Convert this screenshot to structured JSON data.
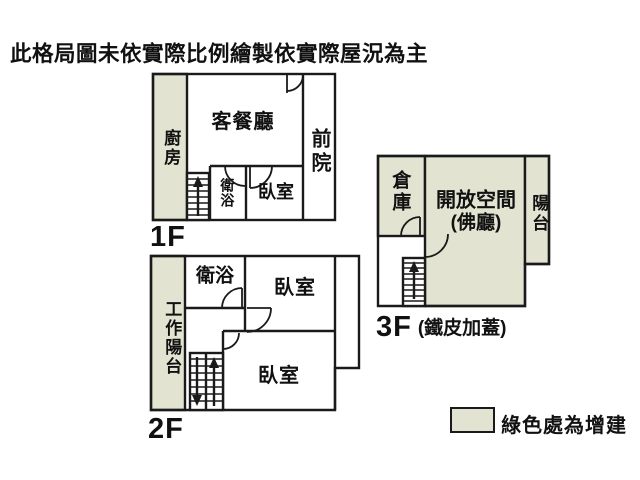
{
  "title": "此格局圖未依實際比例繪製依實際屋況為主",
  "colors": {
    "addition_green": "#e2e4d1",
    "wall": "#1a1a1a"
  },
  "floors": {
    "f1": {
      "label": "1F",
      "rooms": {
        "kitchen": "廚房",
        "living_dining": "客餐廳",
        "front_yard": "前院",
        "bathroom": "衛浴",
        "bedroom": "臥室"
      }
    },
    "f2": {
      "label": "2F",
      "rooms": {
        "work_balcony": "工作陽台",
        "bathroom": "衛浴",
        "bedroom_upper": "臥室",
        "bedroom_lower": "臥室"
      }
    },
    "f3": {
      "label": "3F",
      "label_note": "(鐵皮加蓋)",
      "rooms": {
        "storage": "倉庫",
        "open_space": "開放空間",
        "open_space_sub": "(佛廳)",
        "balcony": "陽台"
      }
    }
  },
  "legend": {
    "label": "綠色處為增建"
  }
}
